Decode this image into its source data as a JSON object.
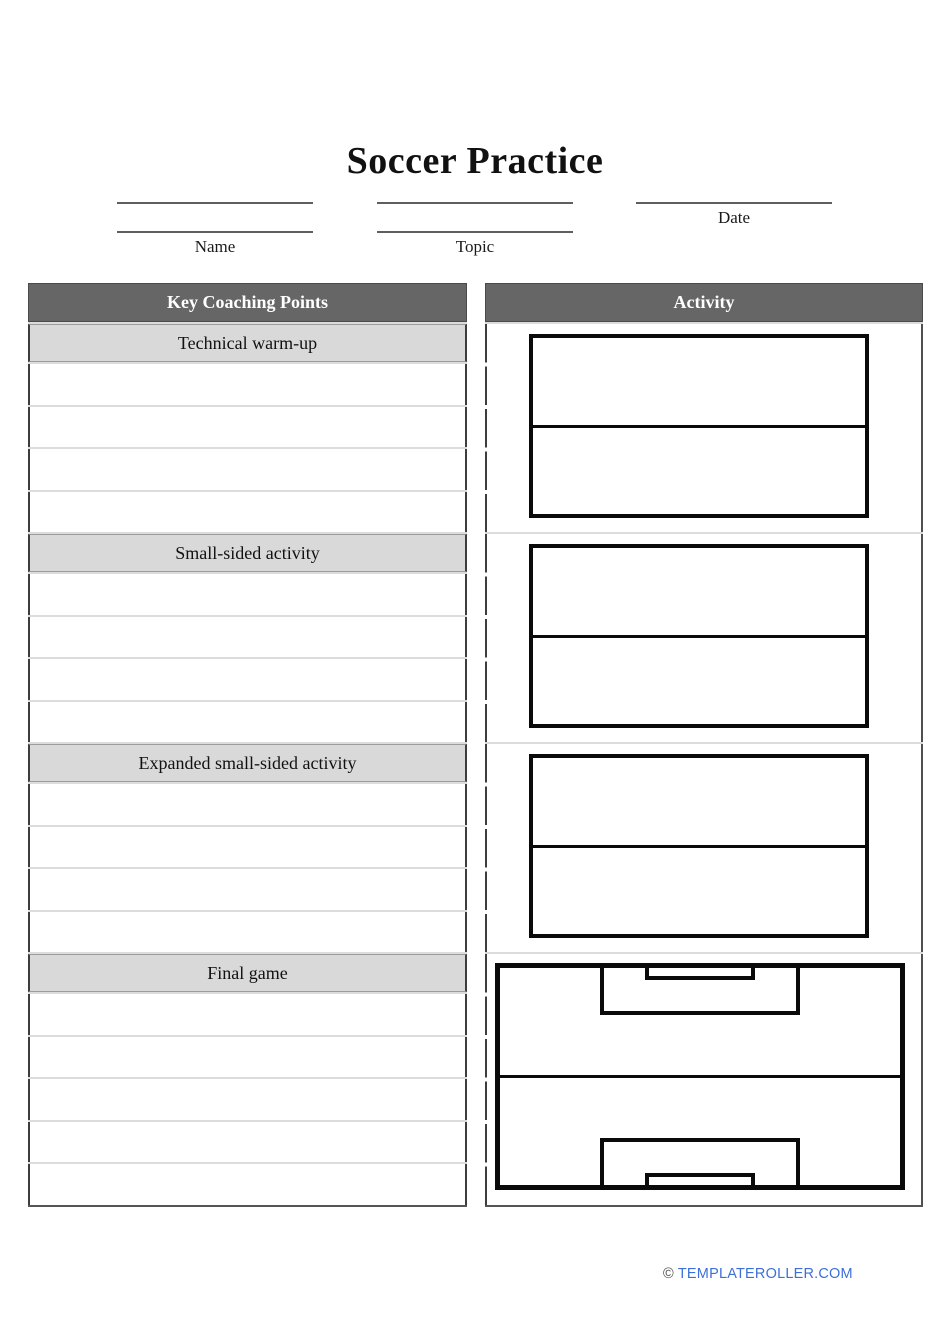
{
  "page": {
    "title": "Soccer Practice"
  },
  "fields": {
    "name": {
      "label": "Name",
      "blank_lines": 2
    },
    "topic": {
      "label": "Topic",
      "blank_lines": 2
    },
    "date": {
      "label": "Date",
      "blank_lines": 1
    }
  },
  "table": {
    "left_header": "Key Coaching Points",
    "right_header": "Activity",
    "sections": [
      {
        "label": "Technical warm-up",
        "blank_rows": 4,
        "diagram": "split-rectangle"
      },
      {
        "label": "Small-sided activity",
        "blank_rows": 4,
        "diagram": "split-rectangle"
      },
      {
        "label": "Expanded small-sided activity",
        "blank_rows": 4,
        "diagram": "split-rectangle"
      },
      {
        "label": "Final game",
        "blank_rows": 5,
        "diagram": "full-soccer-field"
      }
    ]
  },
  "footer": {
    "copyright_symbol": "©",
    "link_text": "TEMPLATEROLLER.COM"
  },
  "colors": {
    "column_header_bg": "#666666",
    "section_row_bg": "#d9d9d9",
    "header_text": "#ffffff",
    "diagram_line": "#0a0a0a",
    "footer_link_blue": "#3e6fd9"
  }
}
